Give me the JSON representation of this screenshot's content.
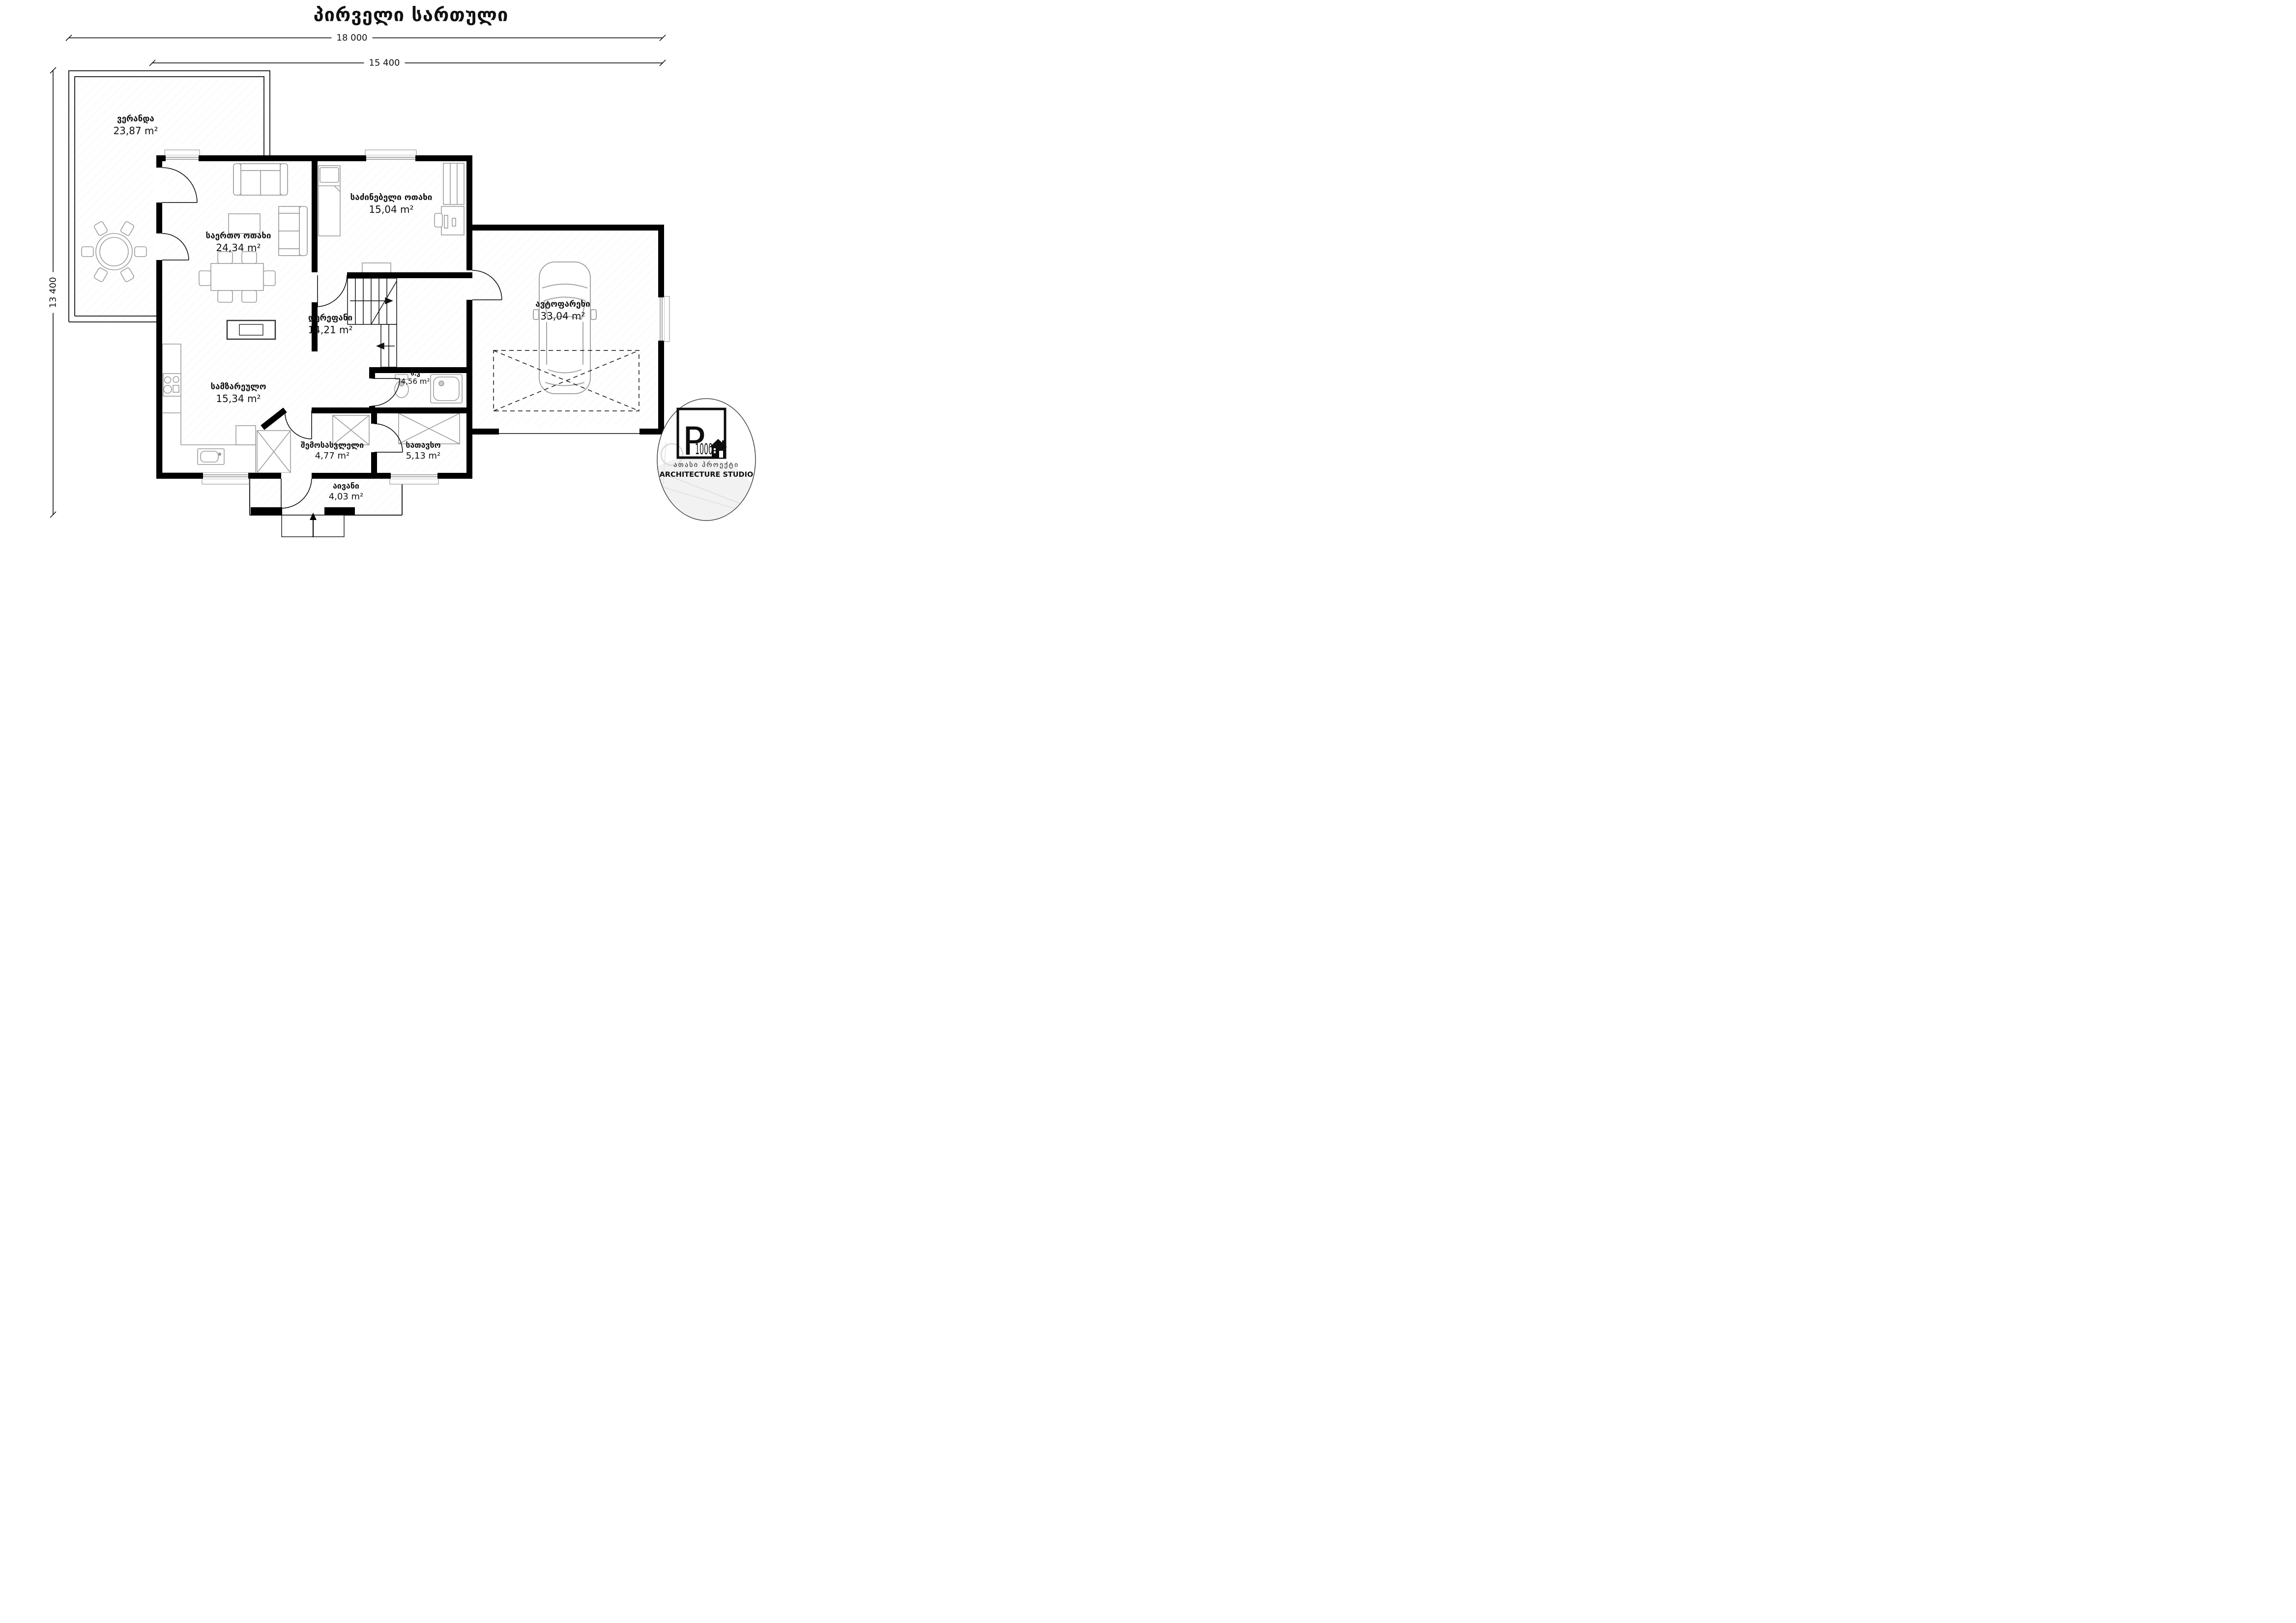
{
  "title": "პირველი სართული",
  "dimensions": {
    "top_outer": "18 000",
    "top_inner": "15 400",
    "left": "13 400"
  },
  "rooms": [
    {
      "id": "veranda",
      "name": "ვერანდა",
      "area": "23,87 m²"
    },
    {
      "id": "bedroom",
      "name": "საძინებელი ოთახი",
      "area": "15,04 m²"
    },
    {
      "id": "living",
      "name": "საერთო ოთახი",
      "area": "24,34 m²"
    },
    {
      "id": "corridor",
      "name": "დერეფანი",
      "area": "14,21 m²"
    },
    {
      "id": "garage",
      "name": "ავტოფარეხი",
      "area": "33,04 m²"
    },
    {
      "id": "kitchen",
      "name": "სამზარეულო",
      "area": "15,34 m²"
    },
    {
      "id": "bathroom",
      "name": "ს.კ",
      "area": "4,56 m²"
    },
    {
      "id": "entrance",
      "name": "შემოსასვლელი",
      "area": "4,77 m²"
    },
    {
      "id": "storage",
      "name": "სათავსო",
      "area": "5,13 m²"
    },
    {
      "id": "balcony",
      "name": "აივანი",
      "area": "4,03 m²"
    }
  ],
  "logo": {
    "letter": "P",
    "number": "1000",
    "subtitle_georgian": "ათასი პროექტი",
    "subtitle_english": "ARCHITECTURE STUDIO"
  },
  "colors": {
    "wall": "#000000",
    "furniture": "#9c9c9c",
    "background": "#ffffff"
  }
}
